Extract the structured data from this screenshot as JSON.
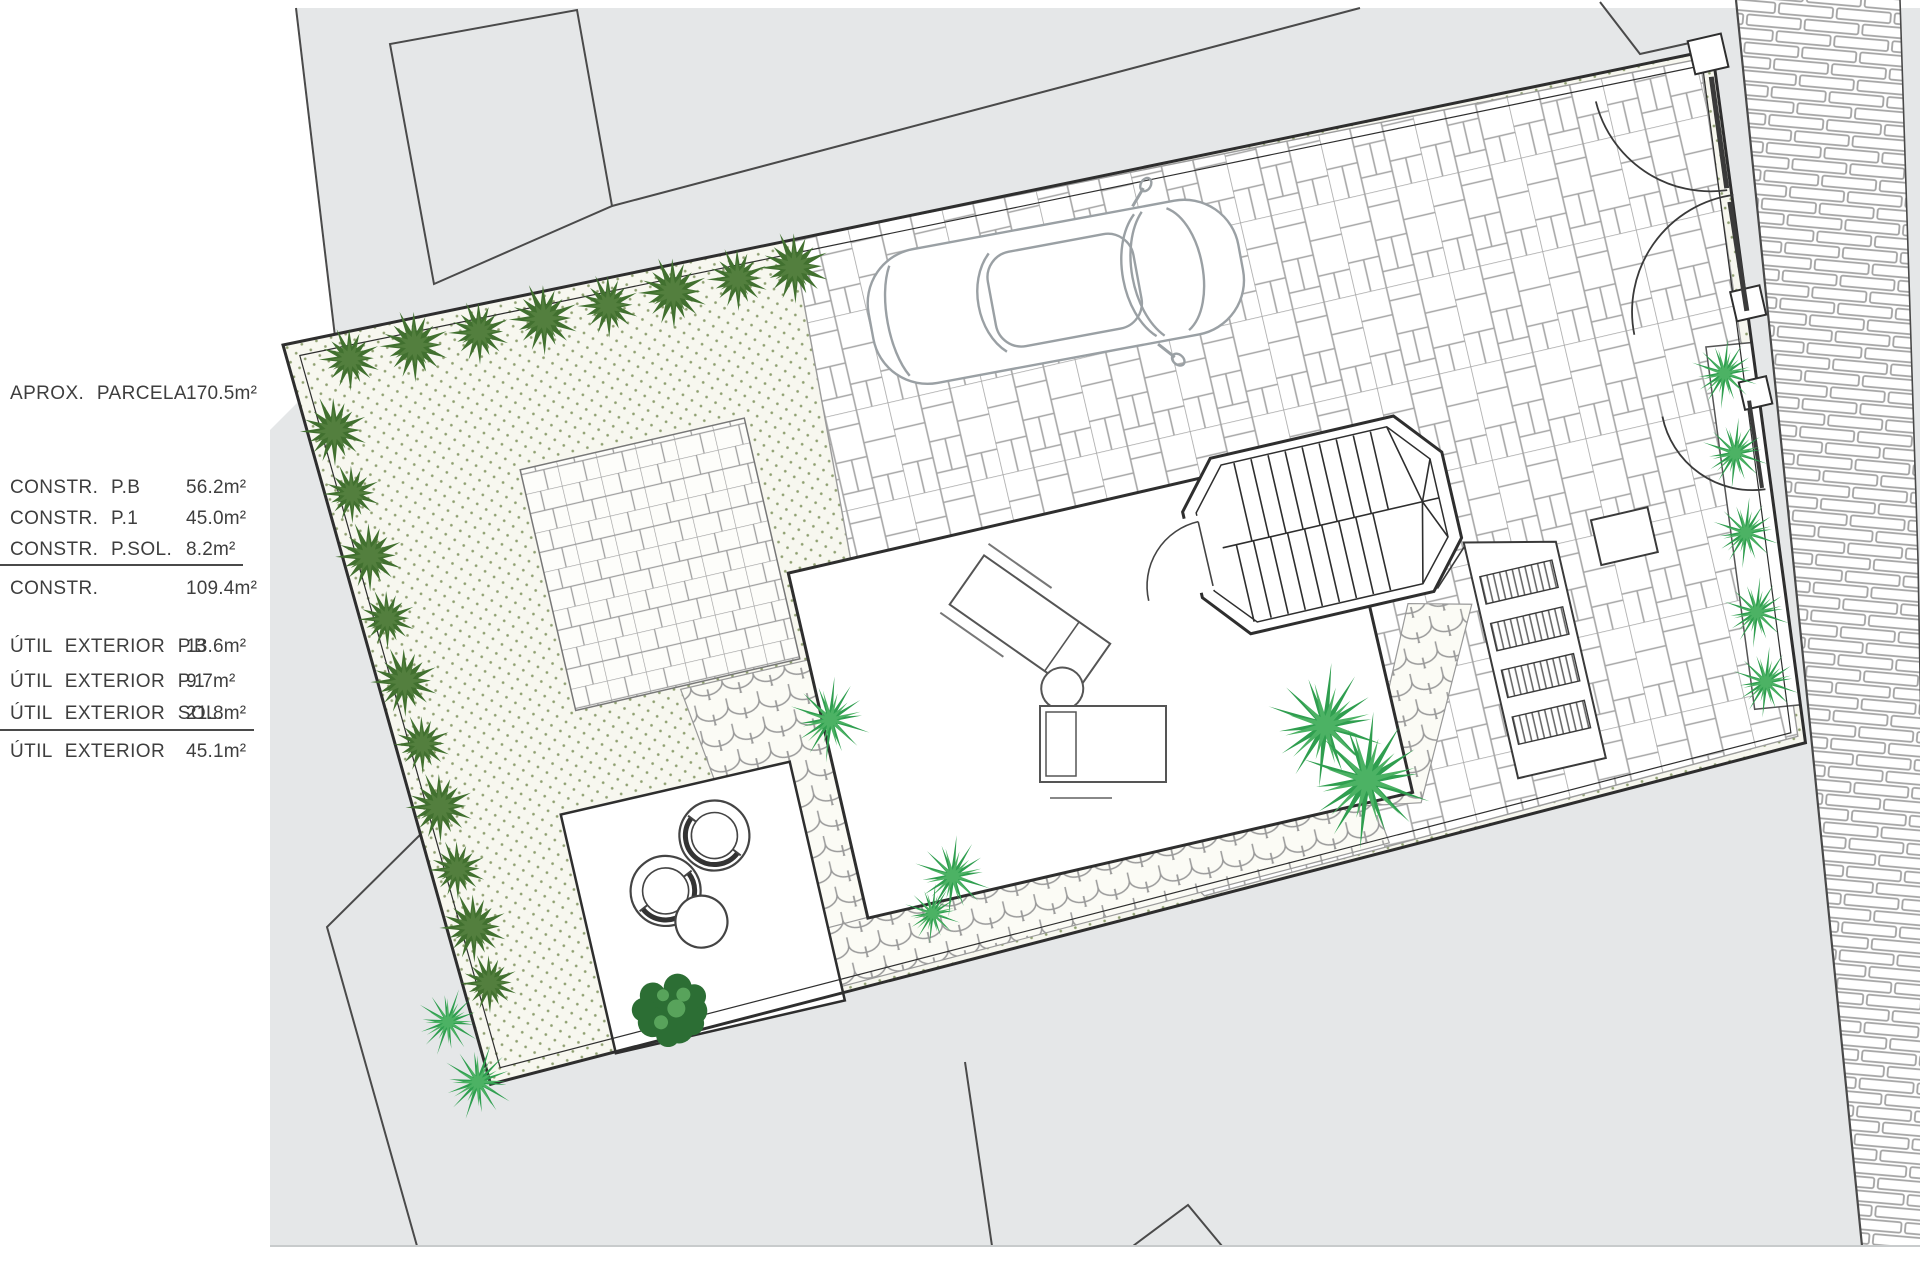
{
  "legend": {
    "rows": [
      {
        "label": "APROX.  PARCELA",
        "value": "170.5m²"
      },
      {
        "label": "CONSTR.  P.B",
        "value": "56.2m²"
      },
      {
        "label": "CONSTR.  P.1",
        "value": "45.0m²"
      },
      {
        "label": "CONSTR.  P.SOL.",
        "value": "8.2m²"
      },
      {
        "label": "CONSTR.",
        "value": "109.4m²"
      },
      {
        "label": "ÚTIL  EXTERIOR  P.B",
        "value": "13.6m²"
      },
      {
        "label": "ÚTIL  EXTERIOR  P.1",
        "value": "9.7m²"
      },
      {
        "label": "ÚTIL  EXTERIOR  SOL.",
        "value": "21.8m²"
      },
      {
        "label": "ÚTIL  EXTERIOR",
        "value": "45.1m²"
      }
    ]
  },
  "plan": {
    "colors": {
      "map_bg": "#e5e7e8",
      "line": "#3c3c3c",
      "wall": "#2e2e2e",
      "light_line": "#a6a6a6",
      "garden_bg": "#f7f7ef",
      "garden_dot": "#8fa071",
      "shrub": "#41702f",
      "shrub_hi": "#537f3e",
      "palm": "#2f9e4f",
      "palm_hi": "#4cb264",
      "tree": "#2c6e34",
      "tree_hi": "#58a35b",
      "car_line": "#9aa0a4",
      "furniture": "#555555"
    },
    "symbols": [
      "plot-wall",
      "garden",
      "driveway-pavers",
      "brick-sidewalk",
      "cobble-path",
      "flagstone-pad",
      "terrace",
      "patio",
      "octagon-staircase",
      "slatted-steps",
      "planter",
      "gate-arcs",
      "car",
      "shrubs",
      "palms",
      "tree",
      "egg-chairs",
      "loungers",
      "neighbor-buildings"
    ]
  }
}
